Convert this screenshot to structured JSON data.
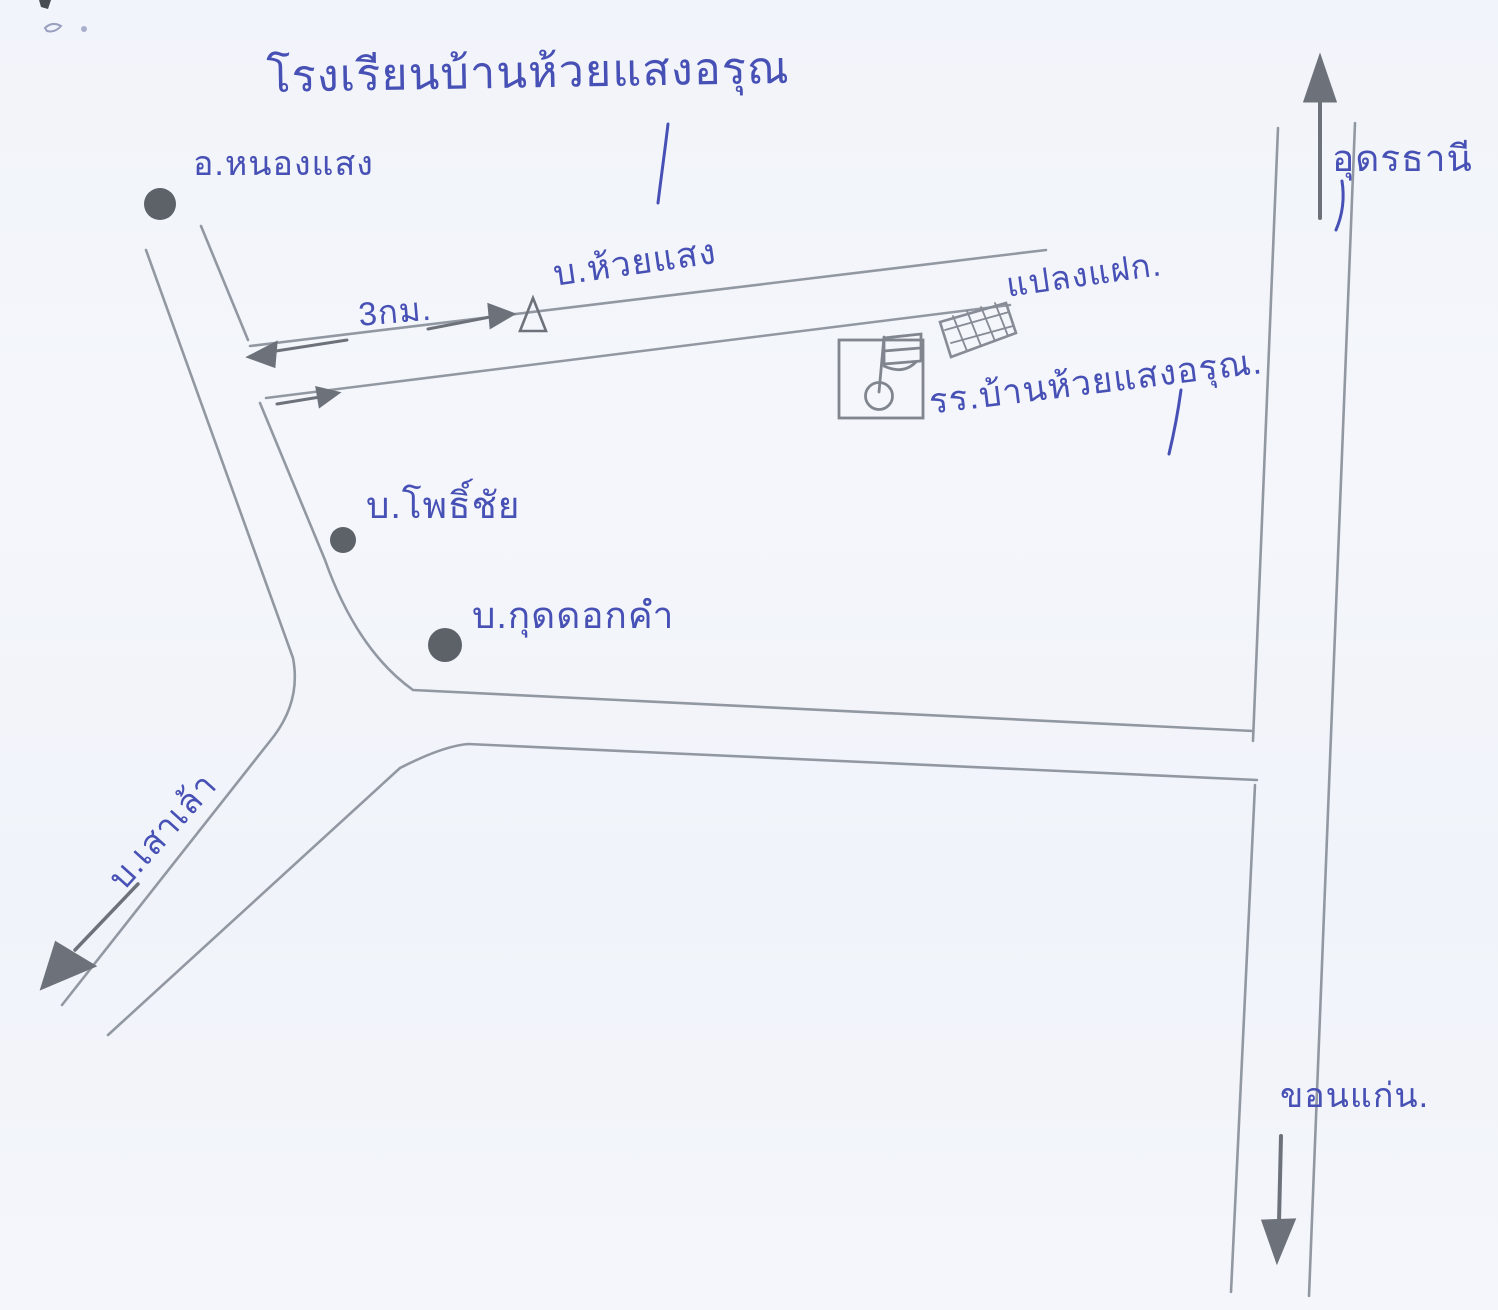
{
  "map": {
    "title": "โรงเรียนบ้านห้วยแสงอรุณ",
    "labels": {
      "district_nong_saeng": "อ.หนองแสง",
      "distance_3km": "3กม.",
      "ban_huai_saeng": "บ.ห้วยแสง",
      "vetiver_plot": "แปลงแฝก.",
      "school": "รร.บ้านห้วยแสงอรุณ.",
      "ban_pho_chai": "บ.โพธิ์ชัย",
      "ban_kut_dok_kham": "บ.กุดดอกคำ",
      "ban_sao_lao": "บ.เสาเล้า",
      "udon_thani": "อุดรธานี",
      "khon_kaen": "ขอนแก่น."
    },
    "icons": {
      "village_dot": "filled-pencil-dot",
      "village_triangle": "open-triangle-marker",
      "school_flag": "flag-in-box-symbol",
      "vetiver_crosshatch": "crosshatched-plot",
      "arrow_up": "to-udon-thani",
      "arrow_down": "to-khon-kaen",
      "arrow_down_left": "to-ban-sao-lao",
      "arrow_left_right": "3km-distance-arrows"
    },
    "colors": {
      "ink_blue": "#4750b4",
      "pencil_gray": "#9298a2",
      "marker_dark": "#5d6269",
      "paper": "#f3f5fa"
    }
  }
}
